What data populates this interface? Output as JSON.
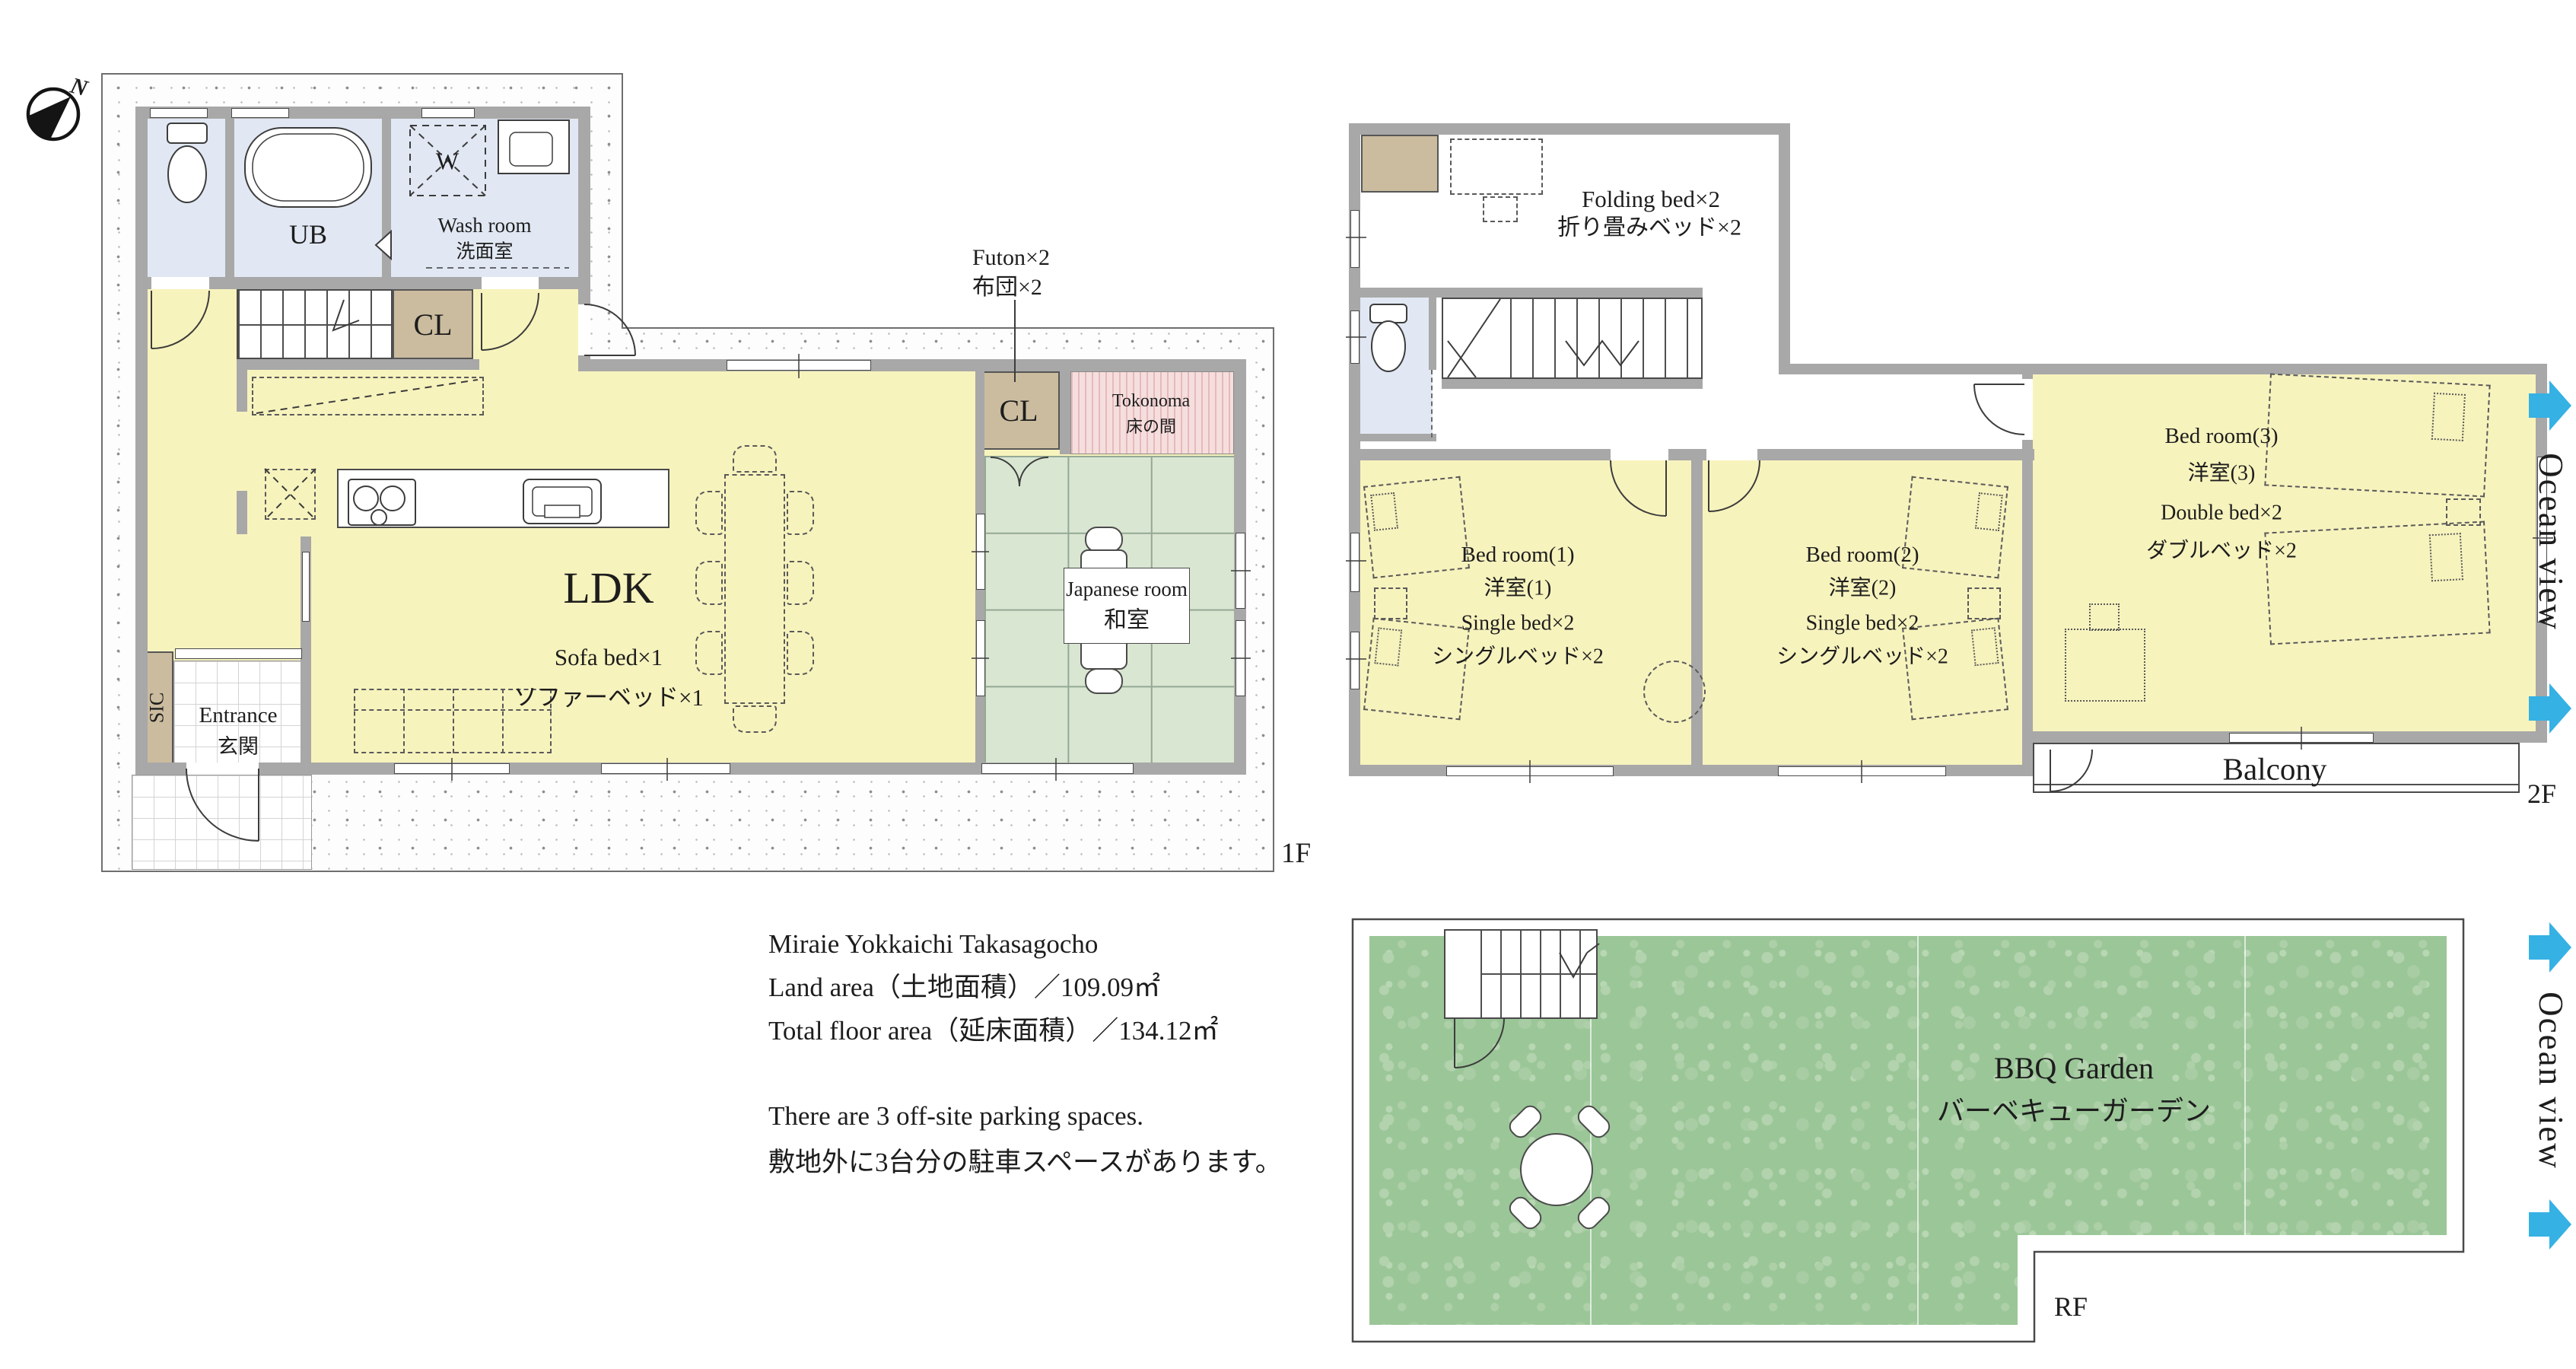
{
  "colors": {
    "wall_gray": "#a8a8a8",
    "room_yellow": "#f7f3bd",
    "room_blue": "#e1e8f3",
    "closet_tan": "#cbbc9f",
    "tatami_green": "#d9e6d2",
    "tokonoma_pink": "#f6dede",
    "grass_green": "#9bc698",
    "ocean_arrow_cyan": "#35b1e4",
    "text": "#1d1d1d"
  },
  "compass": {
    "north_label": "N"
  },
  "floor1": {
    "floor_label": "1F",
    "ub_label": "UB",
    "washroom_label_en": "Wash room",
    "washroom_label_ja": "洗面室",
    "washer_label": "W",
    "hall_closet_label": "CL",
    "ldk_label": "LDK",
    "sofa_label_en": "Sofa bed×1",
    "sofa_label_ja": "ソファーベッド×1",
    "futon_label_en": "Futon×2",
    "futon_label_ja": "布団×2",
    "japanese_closet_label": "CL",
    "tokonoma_label_en": "Tokonoma",
    "tokonoma_label_ja": "床の間",
    "japanese_room_label_en": "Japanese room",
    "japanese_room_label_ja": "和室",
    "entrance_label_en": "Entrance",
    "entrance_label_ja": "玄関",
    "sic_label": "SIC"
  },
  "floor2": {
    "floor_label": "2F",
    "folding_bed_label_en": "Folding bed×2",
    "folding_bed_label_ja": "折り畳みベッド×2",
    "bedroom1": {
      "name_en": "Bed room(1)",
      "name_ja": "洋室(1)",
      "beds_en": "Single bed×2",
      "beds_ja": "シングルベッド×2"
    },
    "bedroom2": {
      "name_en": "Bed room(2)",
      "name_ja": "洋室(2)",
      "beds_en": "Single bed×2",
      "beds_ja": "シングルベッド×2"
    },
    "bedroom3": {
      "name_en": "Bed room(3)",
      "name_ja": "洋室(3)",
      "beds_en": "Double bed×2",
      "beds_ja": "ダブルベッド×2"
    },
    "balcony_label": "Balcony"
  },
  "roof": {
    "floor_label": "RF",
    "bbq_label_en": "BBQ Garden",
    "bbq_label_ja": "バーベキューガーデン"
  },
  "ocean_view_label": "Ocean view",
  "property_info": {
    "name": "Miraie Yokkaichi Takasagocho",
    "land_area": "Land area（土地面積）／109.09㎡",
    "total_floor_area": "Total floor area（延床面積）／134.12㎡",
    "parking_en": "There are 3 off-site parking spaces.",
    "parking_ja": "敷地外に3台分の駐車スペースがあります。"
  }
}
